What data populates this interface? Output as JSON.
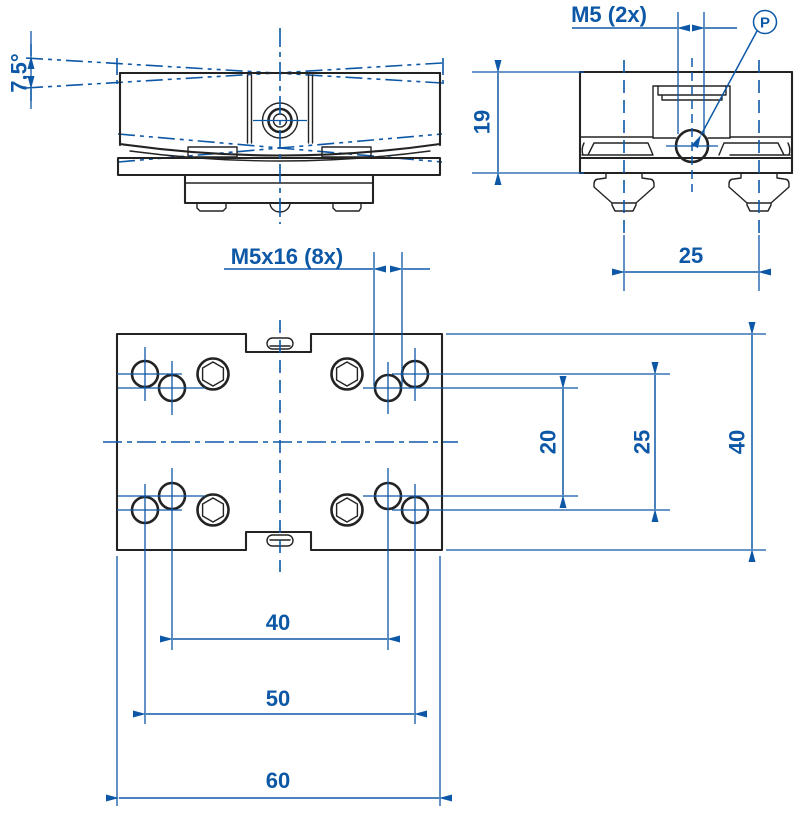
{
  "colors": {
    "bg": "#ffffff",
    "ink": "#232323",
    "dim": "#0d58a6"
  },
  "front_view": {
    "angle_label": "7,5°"
  },
  "side_view": {
    "thread_label": "M5 (2x)",
    "port_label": "P",
    "height_label": "19",
    "foot_spacing_label": "25"
  },
  "plan_view": {
    "thread_label": "M5x16 (8x)",
    "hole_pitch_y_inner_label": "20",
    "hole_pitch_y_outer_label": "25",
    "plate_depth_label": "40",
    "hole_pitch_x_inner_label": "40",
    "hole_pitch_x_outer_label": "50",
    "plate_width_label": "60"
  }
}
